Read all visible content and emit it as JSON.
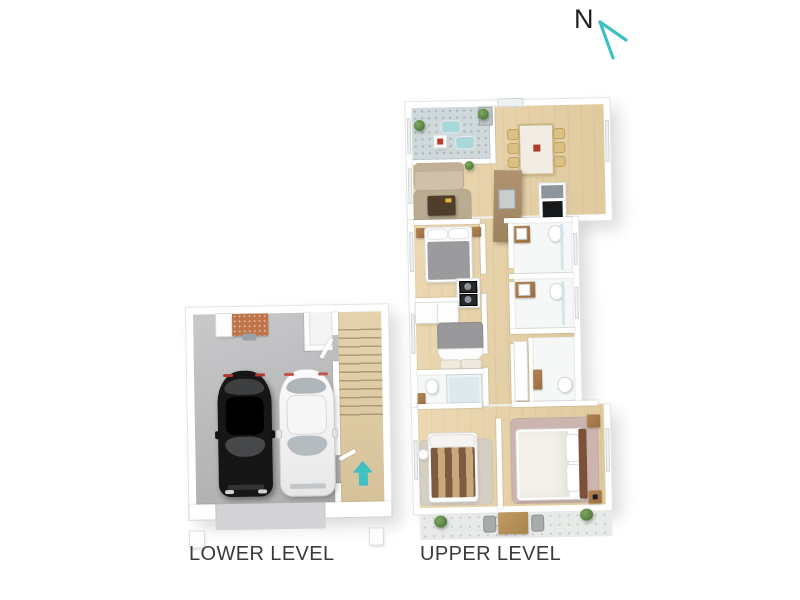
{
  "north": {
    "label": "N"
  },
  "lower_level": {
    "label": "LOWER LEVEL",
    "rooms": [
      "garage",
      "staircase"
    ],
    "items": [
      "workbench",
      "black-car",
      "white-car",
      "stairs-up-arrow"
    ]
  },
  "upper_level": {
    "label": "UPPER LEVEL",
    "rooms": [
      "balcony",
      "dining-room",
      "kitchen",
      "living-room",
      "bedroom-1",
      "bathroom-1",
      "laundry",
      "bedroom-2",
      "bathroom-2",
      "bathroom-3",
      "walk-in-robe",
      "ensuite",
      "bedroom-3",
      "master-bedroom",
      "rear-patio"
    ],
    "items": [
      "lounge-chairs",
      "outdoor-table",
      "dining-table",
      "dining-chairs",
      "sofa",
      "coffee-table",
      "kitchen-island",
      "cooktop",
      "beds",
      "toilets",
      "vanities",
      "shower",
      "stacked-washer-dryer",
      "wardrobes",
      "patio-table",
      "garden-bushes"
    ]
  },
  "colors": {
    "accent": "#3fc0c5",
    "wall": "#ffffff",
    "wood_floor": "#e8d5ad",
    "garage_floor": "#b8b8ba",
    "tile_floor": "#cfd9dc",
    "patio_floor": "#e8eae8",
    "text": "#3a3a3a"
  }
}
